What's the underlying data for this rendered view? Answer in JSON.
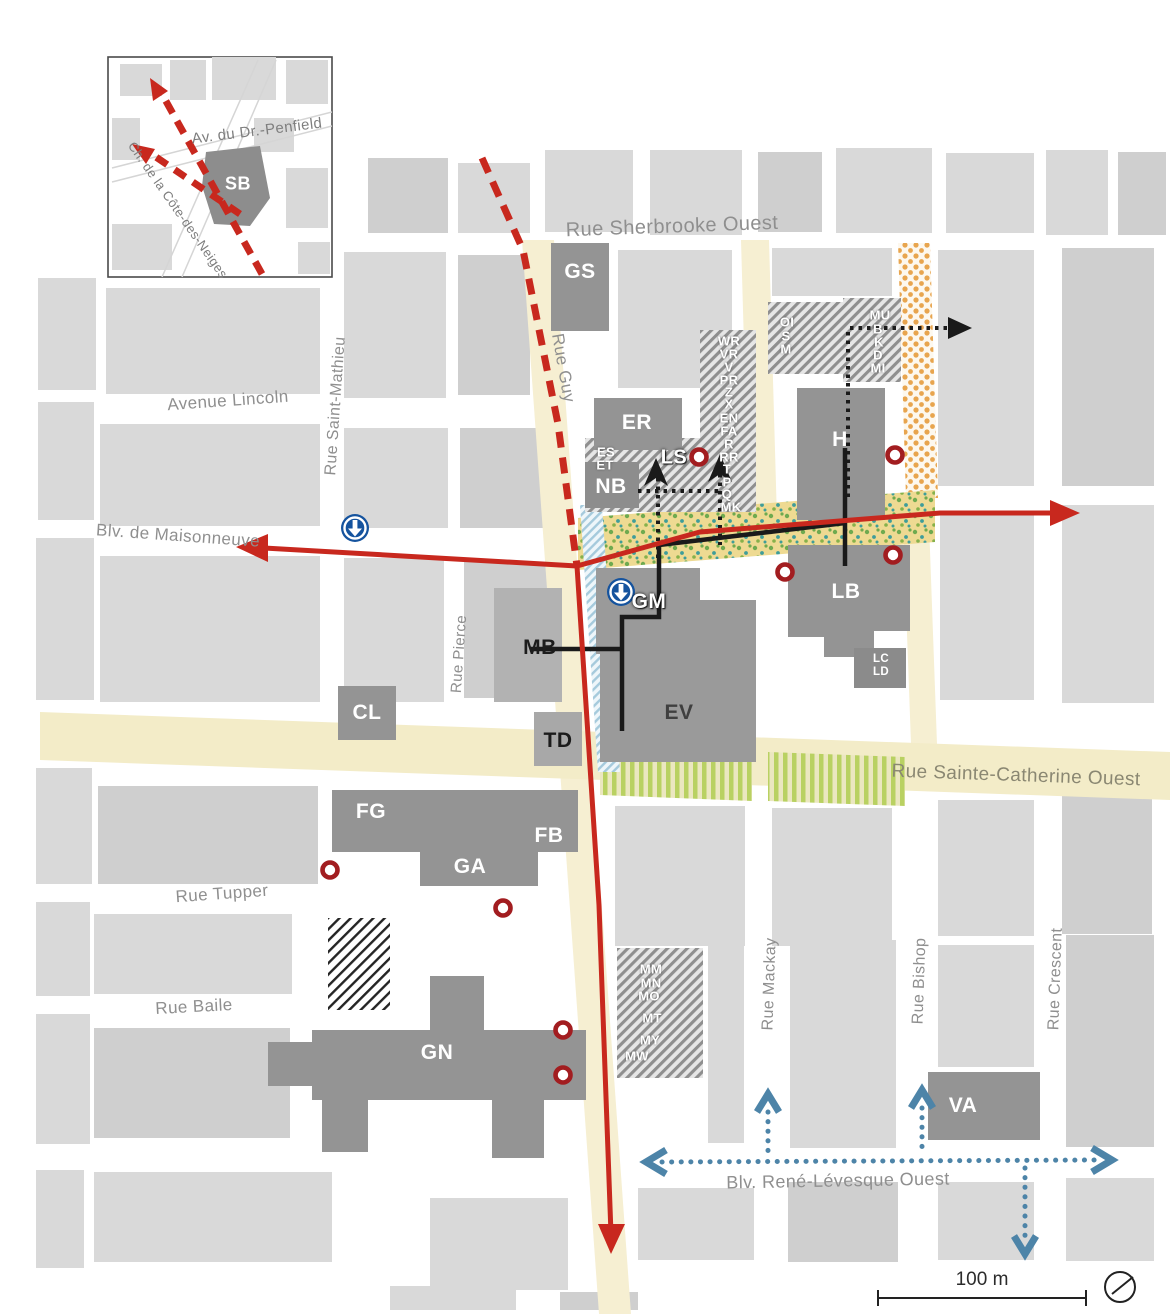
{
  "streets": {
    "sherbrooke": "Rue Sherbrooke Ouest",
    "guy": "Rue Guy",
    "lincoln": "Avenue Lincoln",
    "saint_mathieu": "Rue Saint-Mathieu",
    "maisonneuve": "Blv. de Maisonneuve",
    "pierce": "Rue Pierce",
    "sainte_catherine": "Rue Sainte-Catherine Ouest",
    "tupper": "Rue Tupper",
    "baile": "Rue Baile",
    "mackay": "Rue Mackay",
    "bishop": "Rue Bishop",
    "crescent": "Rue Crescent",
    "rene_levesque": "Blv. René-Lévesque Ouest",
    "penfield": "Av. du Dr.-Penfield",
    "cote_des_neiges": "Ch. de la Côte-des-Neiges"
  },
  "buildings": {
    "gs": "GS",
    "er": "ER",
    "nb": "NB",
    "ls": "LS",
    "h": "H",
    "lb": "LB",
    "gm": "GM",
    "ev": "EV",
    "mb": "MB",
    "td": "TD",
    "cl": "CL",
    "fg": "FG",
    "fb": "FB",
    "ga": "GA",
    "gn": "GN",
    "va": "VA",
    "sb": "SB"
  },
  "annex_labels": {
    "col_guy": [
      "WR",
      "VR",
      "V",
      "PR",
      "Z",
      "X",
      "EN",
      "FA",
      "R",
      "RR",
      "T",
      "P",
      "Q",
      "MK"
    ],
    "es_et": [
      "ES",
      "ET"
    ],
    "oi_col": [
      "OI",
      "S",
      "M"
    ],
    "mu_col": [
      "MU",
      "B",
      "K",
      "D",
      "MI"
    ],
    "lc_col": [
      "LC",
      "LD"
    ],
    "mm_col": [
      "MM",
      "MN",
      "MO",
      "MT",
      "MY",
      "MW"
    ]
  },
  "legend": {
    "scale_label": "100 m"
  },
  "icons": {
    "metro": "metro-station-icon",
    "poi": "red-ring-marker",
    "north": "north-compass-icon"
  },
  "colors": {
    "route_red": "#c8281e",
    "marker_red": "#a21d20",
    "transit_blue": "#4d84a8",
    "metro_blue": "#15539e",
    "corridor_yellow": "#eeda92",
    "street_highlight": "#f6efd2",
    "green_stripe": "#b9d162",
    "orange_dot": "#e8a54e",
    "building_gray": "#949494"
  }
}
